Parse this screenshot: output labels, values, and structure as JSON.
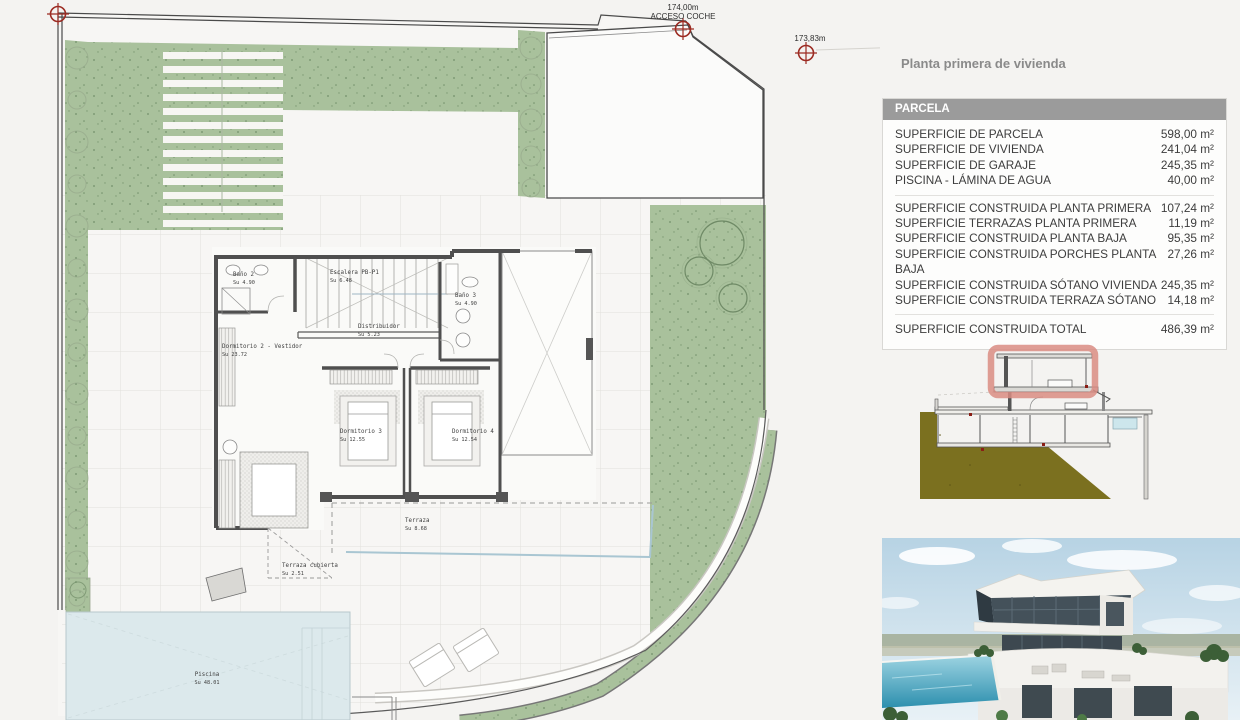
{
  "markers": {
    "m1_elev": "174,00m",
    "m1_label": "ACCESO COCHE",
    "m2_elev": "173,83m"
  },
  "rooms": {
    "bano2": {
      "name": "Baño 2",
      "area": "Su 4.90"
    },
    "escalera": {
      "name": "Escalera PB-P1",
      "area": "Su 6.48"
    },
    "bano3": {
      "name": "Baño 3",
      "area": "Su 4.90"
    },
    "distribuidor": {
      "name": "Distribuidor",
      "area": "Su 5.23"
    },
    "dormitorio2": {
      "name": "Dormitorio 2 - Vestidor",
      "area": "Su 23.72"
    },
    "dormitorio3": {
      "name": "Dormitorio 3",
      "area": "Su 12.55"
    },
    "dormitorio4": {
      "name": "Dormitorio 4",
      "area": "Su 12.54"
    },
    "terraza": {
      "name": "Terraza",
      "area": "Su 8.68"
    },
    "terraza_cubierta": {
      "name": "Terraza cubierta",
      "area": "Su 2.51"
    },
    "piscina": {
      "name": "Piscina",
      "area": "Su 48.01"
    }
  },
  "panel": {
    "title": "Planta primera de vivienda",
    "table": {
      "header": "PARCELA",
      "rows1": [
        {
          "label": "SUPERFICIE DE PARCELA",
          "value": "598,00 m²"
        },
        {
          "label": "SUPERFICIE DE VIVIENDA",
          "value": "241,04 m²"
        },
        {
          "label": "SUPERFICIE DE GARAJE",
          "value": "245,35 m²"
        },
        {
          "label": "PISCINA - LÁMINA DE AGUA",
          "value": "40,00 m²"
        }
      ],
      "rows2": [
        {
          "label": "SUPERFICIE CONSTRUIDA PLANTA PRIMERA",
          "value": "107,24 m²"
        },
        {
          "label": "SUPERFICIE TERRAZAS PLANTA PRIMERA",
          "value": "11,19 m²"
        },
        {
          "label": "SUPERFICIE CONSTRUIDA PLANTA BAJA",
          "value": "95,35 m²"
        },
        {
          "label": "SUPERFICIE CONSTRUIDA PORCHES PLANTA BAJA",
          "value": "27,26 m²"
        },
        {
          "label": "SUPERFICIE CONSTRUIDA SÓTANO VIVIENDA",
          "value": "245,35 m²"
        },
        {
          "label": "SUPERFICIE CONSTRUIDA TERRAZA SÓTANO",
          "value": "14,18 m²"
        }
      ],
      "total": {
        "label": "SUPERFICIE CONSTRUIDA TOTAL",
        "value": "486,39 m²"
      }
    }
  },
  "colors": {
    "garden_green": "#a9c19c",
    "garden_dot": "#72906a",
    "marker_red": "#9c2b22",
    "highlight_salmon": "#d98c82",
    "pool_blue": "#dce9ec",
    "earth_olive": "#7b701f",
    "wall_gray": "#4f4f4f",
    "table_header_bg": "#9b9b9b",
    "balustrade_blue": "#a9c6d2"
  }
}
